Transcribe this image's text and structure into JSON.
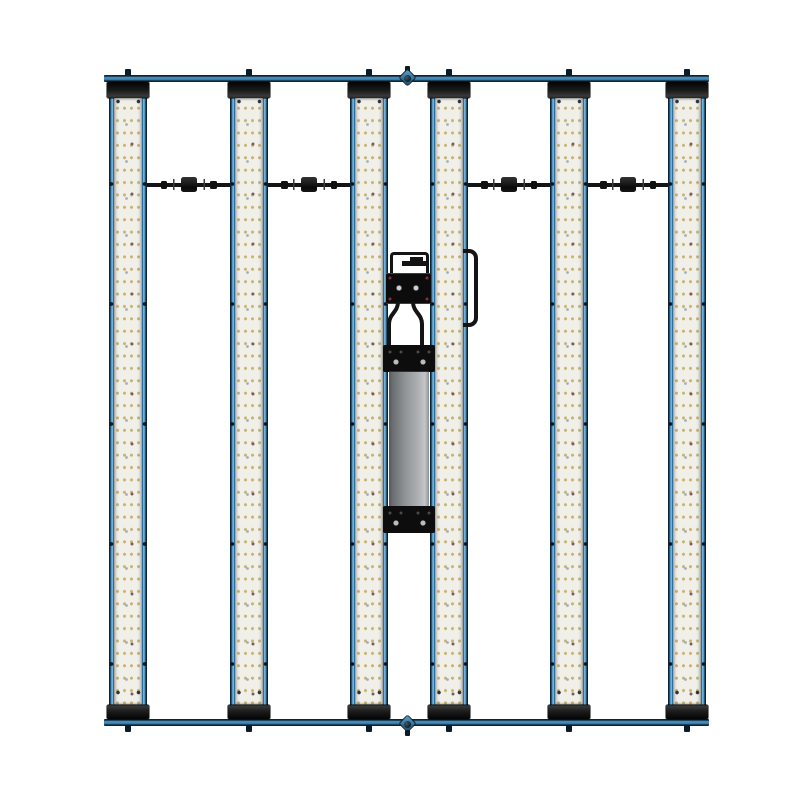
{
  "scene": {
    "type": "product-photo",
    "subject": "Six-bar full-spectrum LED grow light fixture with center-mounted driver, wiring harness connectors, carry handle and two hanging brackets, viewed face-on against a plain white background",
    "background_color": "#ffffff"
  },
  "fixture": {
    "bar_count": 6,
    "led_columns_per_bar": 4,
    "led_rows_per_bar": 49,
    "cable_connector_count": 4,
    "crossbar_count": 2,
    "hanger_count": 2,
    "has_external_driver": true,
    "has_wiring_box": true,
    "has_carry_handle": true
  },
  "colors": {
    "background": "#ffffff",
    "frame-blue": "#3f86b4",
    "frame-blue-light": "#72b2d8",
    "frame-blue-dark": "#0b2335",
    "board-white": "#f0efe8",
    "led-warm": "#c6b171",
    "led-cool": "#9fb0c0",
    "led-deep": "#7d5a63",
    "end-cap-black": "#161616",
    "wire-black": "#141414",
    "driver-gray-dark": "#55585c",
    "driver-gray-light": "#c3c6c8",
    "bracket-black": "#0d0d0d",
    "accent-red": "#7e2430"
  }
}
